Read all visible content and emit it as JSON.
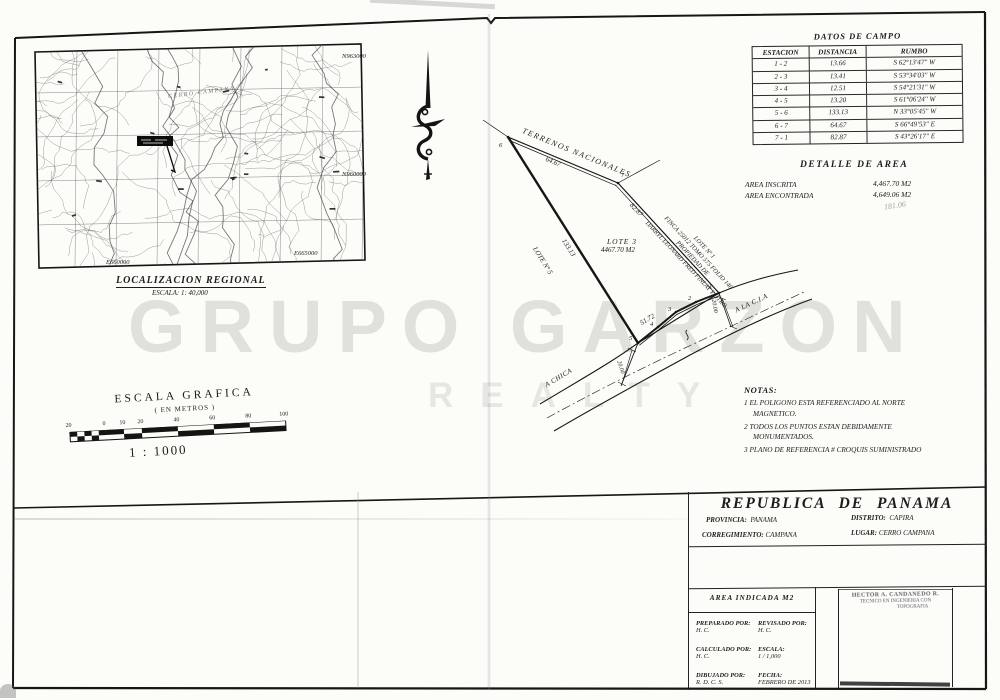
{
  "watermark": {
    "line1": "GRUPO GARZON",
    "line2": "REALTY"
  },
  "regional_map": {
    "title": "LOCALIZACION REGIONAL",
    "scale": "ESCALA: 1: 40,000",
    "n_top": "N963000",
    "n_mid": "N960000",
    "e_left": "E660000",
    "e_right": "E665000",
    "area_label": "CERRO CAMPANA"
  },
  "field_data": {
    "title": "DATOS DE CAMPO",
    "col_station": "ESTACION",
    "col_distance": "DISTANCIA",
    "col_bearing": "RUMBO",
    "rows": [
      {
        "station": "1 - 2",
        "distance": "13.66",
        "bearing": "S 62°13'47\" W"
      },
      {
        "station": "2 - 3",
        "distance": "13.41",
        "bearing": "S 53°34'03\" W"
      },
      {
        "station": "3 - 4",
        "distance": "12.51",
        "bearing": "S 54°21'31\" W"
      },
      {
        "station": "4 - 5",
        "distance": "13.20",
        "bearing": "S 61°06'24\" W"
      },
      {
        "station": "5 - 6",
        "distance": "133.13",
        "bearing": "N 33°05'45\" W"
      },
      {
        "station": "6 - 7",
        "distance": "64.67",
        "bearing": "S 66°49'53\" E"
      },
      {
        "station": "7 - 1",
        "distance": "82.87",
        "bearing": "S 43°26'17\" E"
      }
    ]
  },
  "area_detail": {
    "title": "DETALLE DE AREA",
    "inscrita_label": "AREA INSCRITA",
    "inscrita_value": "4,467.70 M2",
    "encontrada_label": "AREA ENCONTRADA",
    "encontrada_value": "4,649.06 M2",
    "handwritten_note": "181.06"
  },
  "notes": {
    "title": "NOTAS:",
    "item1": "1  EL POLIGONO ESTA REFERENCIADO AL NORTE MAGNETICO.",
    "item2": "2  TODOS LOS PUNTOS ESTAN DEBIDAMENTE MONUMENTADOS.",
    "item3": "3  PLANO DE REFERENCIA # CROQUIS SUMINISTRADO"
  },
  "survey": {
    "boundary_top": "TERRENOS NACIONALES",
    "lot_name": "LOTE 3",
    "lot_area": "4467.70 M2",
    "edge_6_7": "64.67",
    "edge_7_1": "82.87",
    "edge_5_6": "133.13",
    "frontage": "51.72",
    "neighbor_left": "LOTE Nº 5",
    "neighbor_right_line1": "LOTE Nº 1",
    "neighbor_right_line2": "FINCA 25012 TOMO 575 FOLIO 146",
    "neighbor_right_line3": "PROPIEDAD DE",
    "neighbor_right_line4": "DARRYL LEONARD FRED FINLAY Y OTRO",
    "road_left": "A CHICA",
    "road_right": "A LA C.I.A",
    "road_width_left": "20.00",
    "road_width_right": "20.00",
    "v1": "1",
    "v2": "2",
    "v3": "3",
    "v4": "4",
    "v5": "5",
    "v6": "6",
    "v7": "7"
  },
  "graphic_scale": {
    "title": "ESCALA GRAFICA",
    "subtitle": "( EN METROS )",
    "ratio": "1 : 1000",
    "ticks": [
      "20",
      "0",
      "10",
      "20",
      "40",
      "60",
      "80",
      "100"
    ]
  },
  "title_block": {
    "country": "REPUBLICA DE PANAMA",
    "provincia_label": "PROVINCIA:",
    "provincia": "PANAMA",
    "distrito_label": "DISTRITO:",
    "distrito": "CAPIRA",
    "corregimiento_label": "CORREGIMIENTO:",
    "corregimiento": "CAMPANA",
    "lugar_label": "LUGAR:",
    "lugar": "CERRO CAMPANA"
  },
  "credits": {
    "area_box": "AREA INDICADA M2",
    "prepared_label": "PREPARADO POR:",
    "prepared": "H. C.",
    "revised_label": "REVISADO POR:",
    "revised": "H. C.",
    "calculated_label": "CALCULADO POR:",
    "calculated": "H. C.",
    "scale_label": "ESCALA:",
    "scale": "1 / 1,000",
    "drawn_label": "DIBUJADO POR:",
    "drawn": "R. D. C. S.",
    "date_label": "FECHA:",
    "date": "FEBRERO DE 2013"
  },
  "stamp": {
    "line1": "HECTOR A. CANDANEDO R.",
    "line2": "TECNICO EN INGENIERIA CON",
    "line3": "TOPOGRAFIA"
  }
}
